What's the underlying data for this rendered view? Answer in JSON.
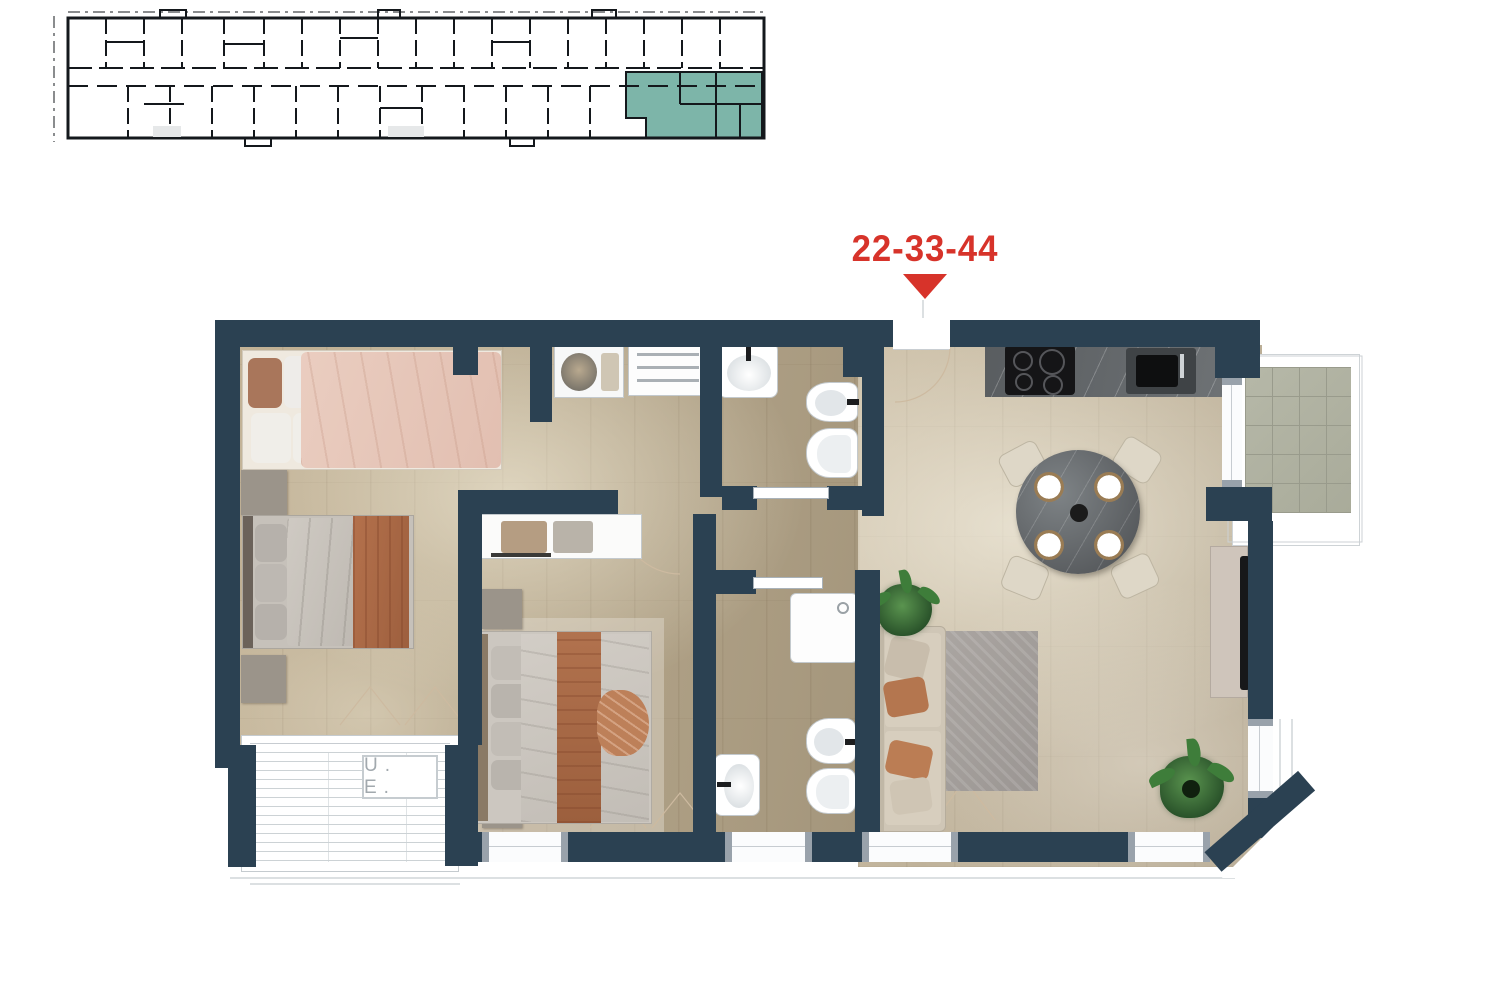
{
  "page": {
    "background": "#ffffff",
    "kind": "apartment floor plan sheet"
  },
  "key_plan": {
    "description": "building key plan with highlighted unit",
    "highlight_color": "#7db5a9",
    "line_color": "#14181c"
  },
  "unit_marker": {
    "label": "22-33-44",
    "color": "#d7332a"
  },
  "floor_plan": {
    "wall_color": "#2b4152",
    "floor_color": "#b6a78c",
    "terrace_label": "U. E.",
    "rooms": [
      {
        "name": "bedroom-1",
        "furniture": [
          "double-bed-pink",
          "nightstand"
        ]
      },
      {
        "name": "bedroom-2",
        "furniture": [
          "double-bed-grey",
          "nightstand",
          "desk",
          "office-chair",
          "shelf-unit"
        ]
      },
      {
        "name": "bedroom-3",
        "furniture": [
          "double-bed-terracotta",
          "wardrobe",
          "nightstand",
          "nightstand"
        ]
      },
      {
        "name": "bathroom-1",
        "fixtures": [
          "washbasin",
          "bidet",
          "toilet"
        ]
      },
      {
        "name": "bathroom-2",
        "fixtures": [
          "shower-tray",
          "washbasin",
          "bidet",
          "toilet"
        ]
      },
      {
        "name": "kitchen-living-room",
        "furniture": [
          "kitchen-counter",
          "cooktop",
          "kitchen-sink",
          "round-dining-table",
          "four-chairs",
          "sofa",
          "rug",
          "tv-console",
          "tv",
          "plant",
          "plant"
        ]
      },
      {
        "name": "terrace",
        "label": "U. E."
      },
      {
        "name": "balcony",
        "finish": "tiled"
      }
    ]
  }
}
